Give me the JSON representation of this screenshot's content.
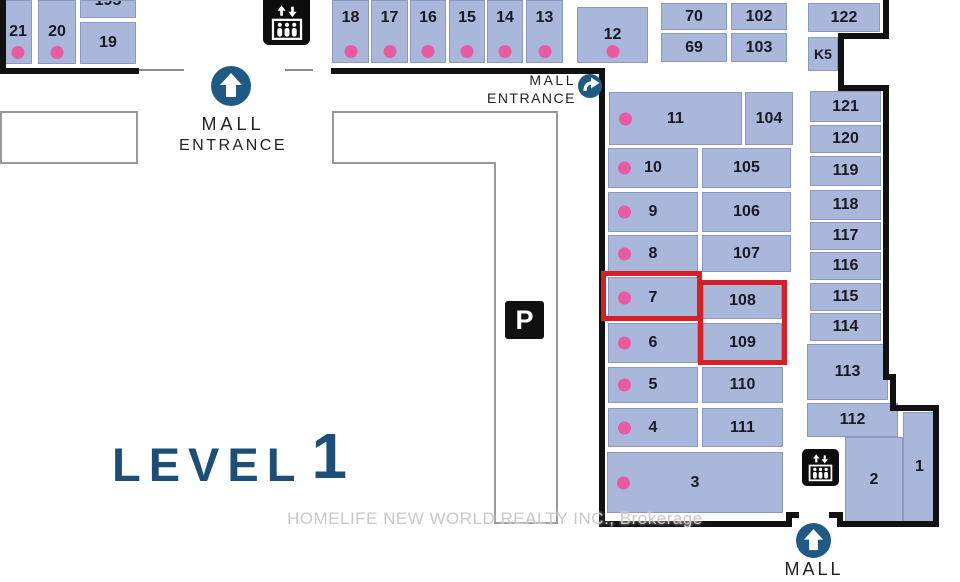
{
  "units": {
    "u21": "21",
    "u20": "20",
    "u19b": "195",
    "u19": "19",
    "u18": "18",
    "u17": "17",
    "u16": "16",
    "u15": "15",
    "u14": "14",
    "u13": "13",
    "u12": "12",
    "u70": "70",
    "u102": "102",
    "u69": "69",
    "u103": "103",
    "u122": "122",
    "uk5": "K5",
    "u121": "121",
    "u120": "120",
    "u119": "119",
    "u118": "118",
    "u117": "117",
    "u116": "116",
    "u115": "115",
    "u114": "114",
    "u113": "113",
    "u112": "112",
    "u11": "11",
    "u104": "104",
    "u10": "10",
    "u105": "105",
    "u9": "9",
    "u106": "106",
    "u8": "8",
    "u107": "107",
    "u7": "7",
    "u108": "108",
    "u6": "6",
    "u109": "109",
    "u5": "5",
    "u110": "110",
    "u4": "4",
    "u111": "111",
    "u3": "3",
    "u2": "2",
    "u1": "1"
  },
  "labels": {
    "level_word": "LEVEL",
    "level_number": "1",
    "parking": "P",
    "watermark": "HOMELIFE NEW WORLD REALTY INC., Brokerage"
  },
  "entrances": {
    "top_left": {
      "line1": "MALL",
      "line2": "ENTRANCE"
    },
    "top_right": {
      "line1": "MALL",
      "line2": "ENTRANCE"
    },
    "bottom": {
      "line1": "MALL"
    }
  },
  "icons": {
    "elevator": "elevator-people-arrows",
    "entrance_up": "arrow-up-circle",
    "entrance_right": "arrow-right-circle"
  },
  "colors": {
    "unit_fill": "#a9b7db",
    "unit_border": "#8a98c2",
    "dot_pink": "#e85ba3",
    "highlight_red": "#d61f26",
    "entrance_blue": "#1f5a85",
    "level_blue": "#1d4e78",
    "wall_black": "#111111"
  }
}
